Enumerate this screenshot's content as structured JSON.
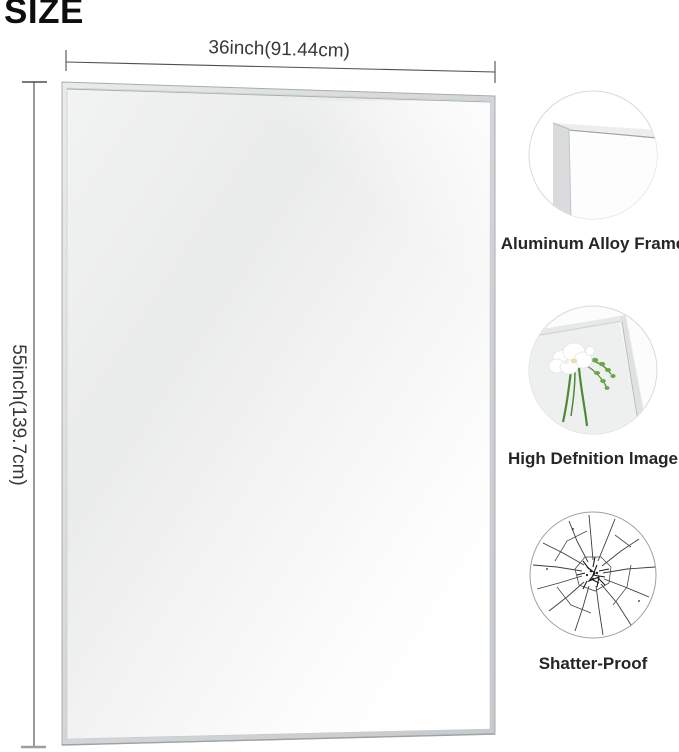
{
  "title": "SIZE",
  "diagram": {
    "name": "mirror-size-diagram",
    "width_label": "36inch(91.44cm)",
    "height_label": "55inch(139.7cm)"
  },
  "features": [
    {
      "label": "Aluminum Alloy Frame",
      "icon": "frame-corner-icon"
    },
    {
      "label": "High Defnition lmage",
      "icon": "flower-reflection-icon"
    },
    {
      "label": "Shatter-Proof",
      "icon": "shattered-glass-icon"
    }
  ],
  "colors": {
    "background": "#ffffff",
    "frame_silver": "#d6d8da",
    "mirror_surface": "#ececec",
    "dimension_line": "#4a4a4a",
    "label_text": "#262626",
    "stem_green": "#4c8a33"
  }
}
